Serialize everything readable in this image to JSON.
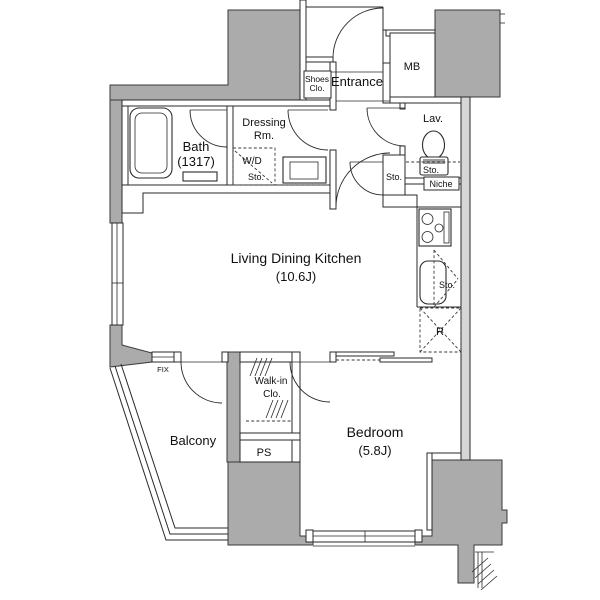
{
  "floorplan": {
    "bath": {
      "name": "Bath",
      "dimensions": "(1317)"
    },
    "dressing_room": {
      "line1": "Dressing",
      "line2": "Rm."
    },
    "washer_dryer": {
      "line1": "W/D",
      "line2": "Sto."
    },
    "shoes_closet": {
      "line1": "Shoes",
      "line2": "Clo."
    },
    "entrance": {
      "name": "Entrance"
    },
    "meter_box": {
      "abbr": "MB"
    },
    "lavatory": {
      "name": "Lav.",
      "storage": "Sto.",
      "niche": "Niche"
    },
    "hall_storage": {
      "name": "Sto."
    },
    "ldk": {
      "name": "Living Dining Kitchen",
      "size": "(10.6J)"
    },
    "kitchen_storage": {
      "name": "Sto."
    },
    "refrigerator": {
      "abbr": "R"
    },
    "fix_window": {
      "label": "FIX"
    },
    "balcony": {
      "name": "Balcony"
    },
    "walkin_closet": {
      "line1": "Walk-in",
      "line2": "Clo."
    },
    "pipe_space": {
      "abbr": "PS"
    },
    "bedroom": {
      "name": "Bedroom",
      "size": "(5.8J)"
    },
    "colors": {
      "wall_fill": "#ababab",
      "light_wall": "#d6d6d6",
      "line": "#2a2a2a"
    }
  }
}
